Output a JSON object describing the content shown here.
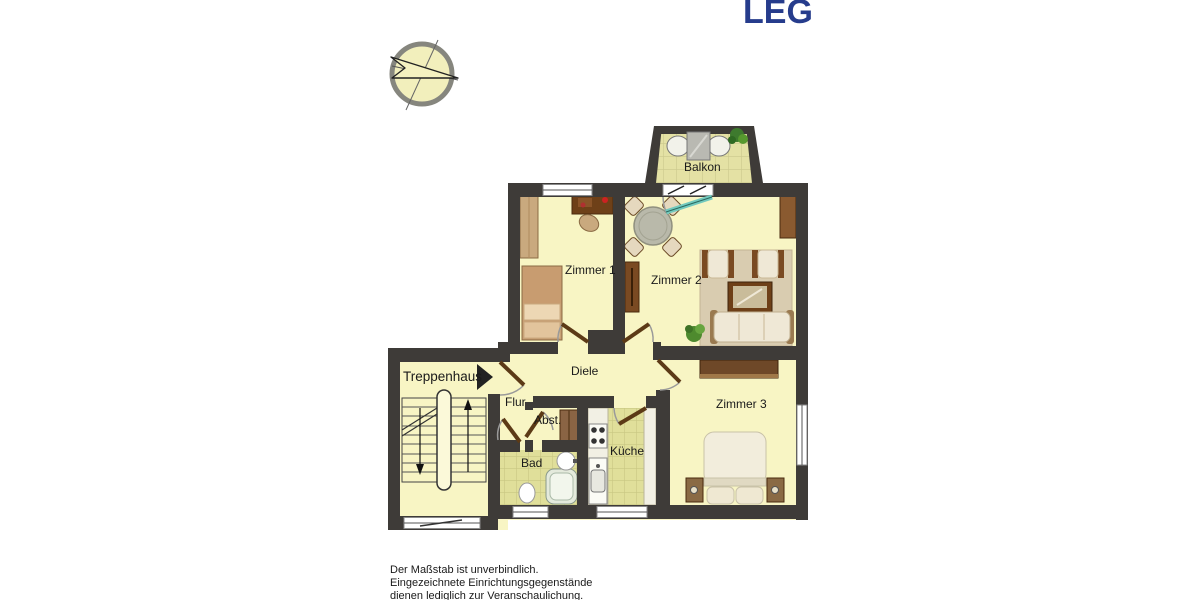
{
  "logo": {
    "text": "LEG",
    "color": "#263c8c"
  },
  "labels": {
    "balkon": "Balkon",
    "zimmer1": "Zimmer 1",
    "zimmer2": "Zimmer 2",
    "zimmer3": "Zimmer 3",
    "treppenhaus": "Treppenhaus",
    "diele": "Diele",
    "flur": "Flur",
    "abst": "Abst.",
    "bad": "Bad",
    "kueche": "Küche"
  },
  "disclaimer": {
    "line1": "Der Maßstab ist unverbindlich.",
    "line2": "Eingezeichnete Einrichtungsgegenstände",
    "line3": "dienen lediglich zur Veranschaulichung."
  },
  "colors": {
    "wall": "#3e3b38",
    "floor": "#f8f5c4",
    "tile": "#e0df9a",
    "logo_blue": "#263c8c",
    "door_leaf": "#5c3a16",
    "balcony_door": "#72c9be"
  }
}
